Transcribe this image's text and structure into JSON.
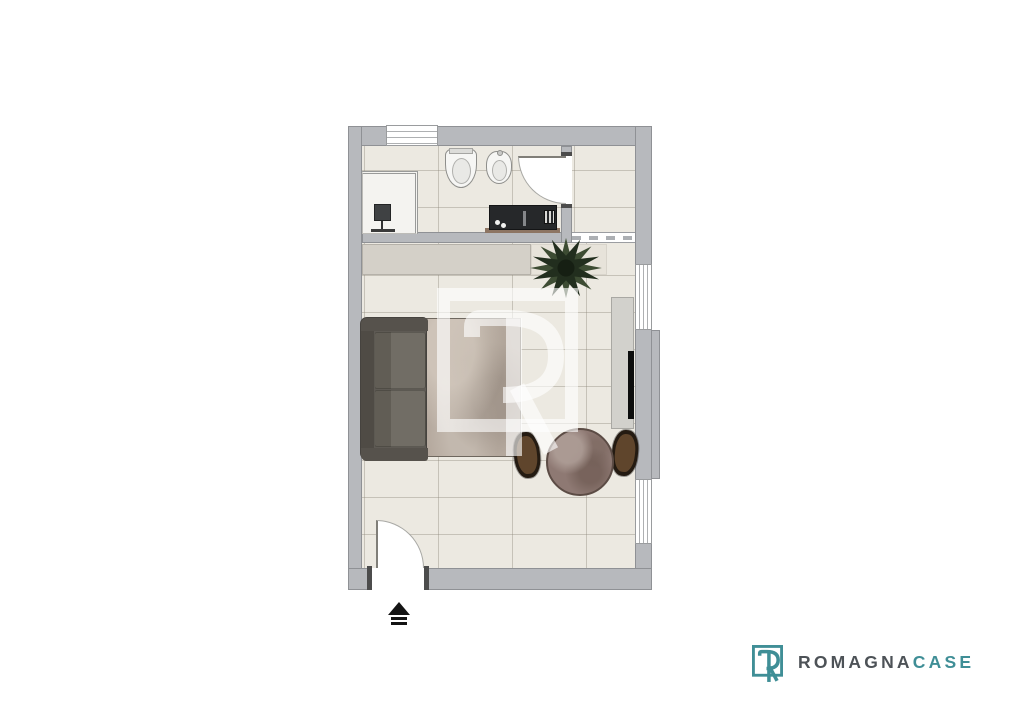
{
  "page": {
    "background": "#FFFFFF",
    "kind": "real-estate floor plan render"
  },
  "floorplan": {
    "rooms": [
      {
        "name": "bathroom",
        "fixtures": [
          "shower",
          "toilet",
          "bidet",
          "vanity-counter"
        ]
      },
      {
        "name": "hallway",
        "fixtures": [
          "dashed-passage-opening"
        ]
      },
      {
        "name": "living-room",
        "furniture": [
          "wardrobe-strip",
          "sofa",
          "rug",
          "round-dining-table",
          "chair-left",
          "chair-right",
          "tv-sideboard",
          "potted-plant"
        ]
      }
    ],
    "openings": [
      "top-wall-window",
      "right-wall-window-upper",
      "right-wall-window-lower",
      "bathroom-door",
      "entrance-door"
    ],
    "entrance_marker": "up-arrow"
  },
  "watermark": {
    "letter": "R",
    "shape": "square-outline",
    "color": "#FFFFFF",
    "opacity": 0.6
  },
  "logo": {
    "icon": "r-square-icon",
    "brand_primary": "ROMAGNA",
    "brand_accent": "CASE"
  },
  "colors": {
    "brand_teal": "#3F8E96",
    "brand_gray": "#4D5257",
    "wall": "#B7B9BD",
    "floor": "#ECE9E1",
    "wardrobe": "#D4D0C8",
    "sofa": "#5E5A54",
    "rug": "#B4A89D",
    "table_marble": "#8E7973",
    "plant": "#2C3A26",
    "counter_dark": "#26282A"
  }
}
